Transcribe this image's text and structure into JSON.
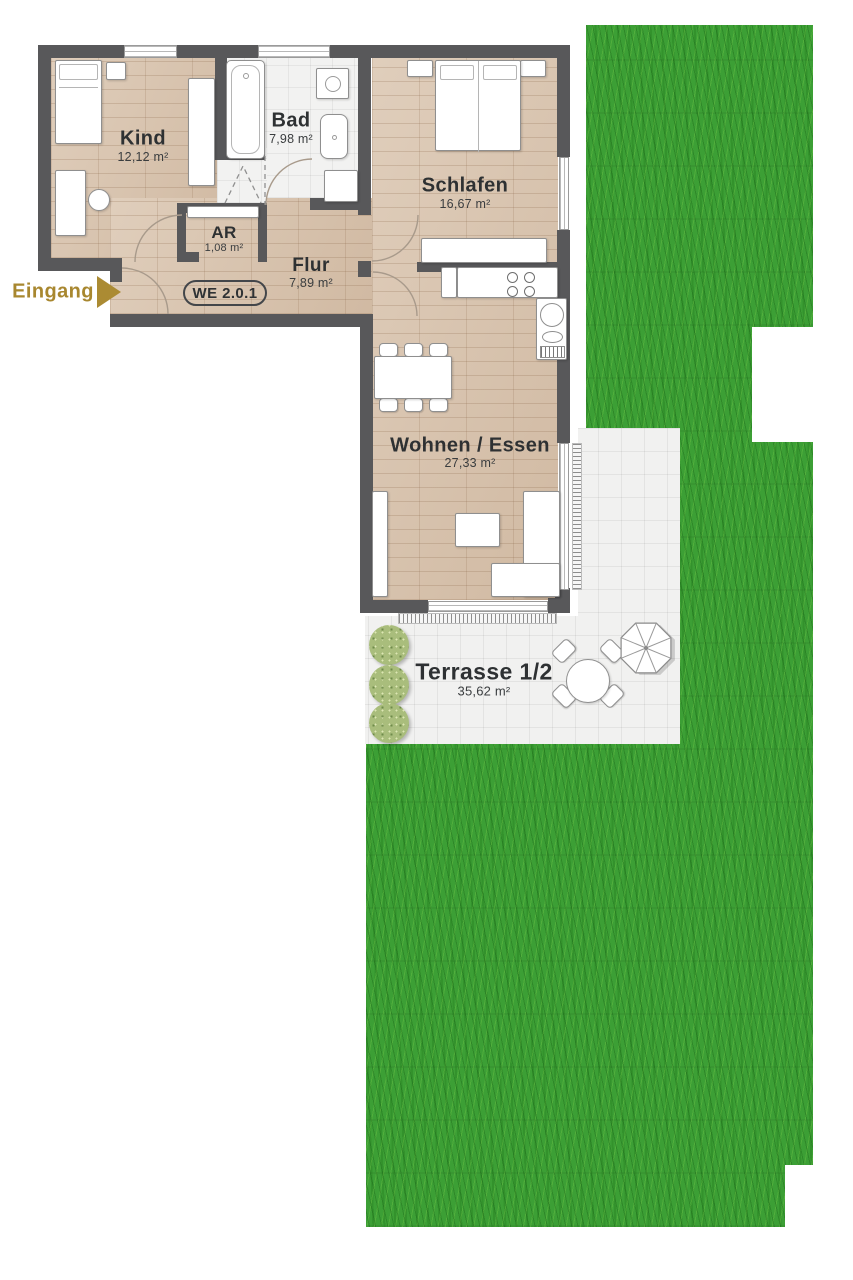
{
  "entrance": {
    "label": "Eingang"
  },
  "unit": {
    "badge": "WE 2.0.1"
  },
  "rooms": {
    "kind": {
      "name": "Kind",
      "area": "12,12 m²"
    },
    "bad": {
      "name": "Bad",
      "area": "7,98 m²"
    },
    "schlafen": {
      "name": "Schlafen",
      "area": "16,67 m²"
    },
    "ar": {
      "name": "AR",
      "area": "1,08 m²"
    },
    "flur": {
      "name": "Flur",
      "area": "7,89 m²"
    },
    "wohnen": {
      "name": "Wohnen / Essen",
      "area": "27,33 m²"
    },
    "terrasse": {
      "name": "Terrasse 1/2",
      "area": "35,62 m²"
    }
  },
  "colors": {
    "wall": "#58585a",
    "wood_floor": "#d8c2ab",
    "tile_floor": "#f2f2f1",
    "grass": "#3c9f35",
    "entrance_gold": "#a8872f",
    "label_text": "#2e3133"
  }
}
